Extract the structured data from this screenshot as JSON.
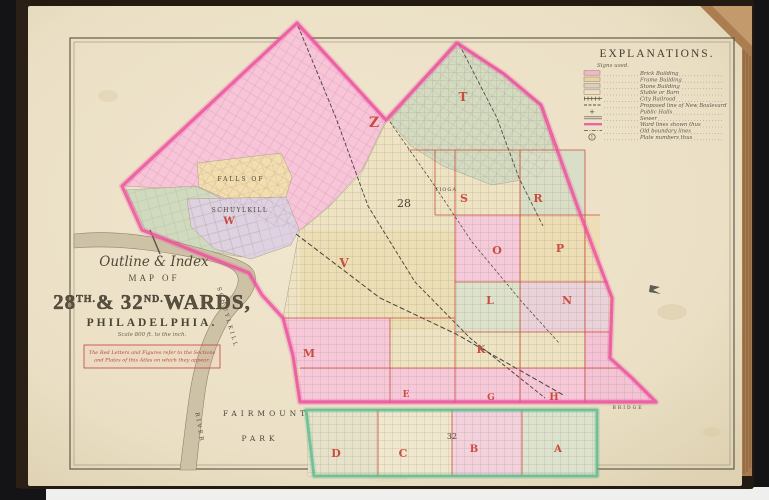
{
  "page_title": "Outline & Index Map of 28th & 32nd Wards, Philadelphia",
  "legend": {
    "title": "EXPLANATIONS.",
    "subtitle": "Signs used.",
    "items": [
      {
        "type": "swatch",
        "color": "#f0b6c9",
        "label": "Brick Building"
      },
      {
        "type": "swatch",
        "color": "#e9d3a2",
        "label": "Frame Building"
      },
      {
        "type": "swatch",
        "color": "#d8d1c0",
        "label": "Stone Building"
      },
      {
        "type": "swatch",
        "color": "none",
        "label": "Stable or Barn"
      },
      {
        "type": "railroad",
        "label": "City Railroad"
      },
      {
        "type": "dashed",
        "label": "Proposed line of New Boulevard"
      },
      {
        "type": "cross",
        "label": "Public Halls"
      },
      {
        "type": "double",
        "label": "Sewer"
      },
      {
        "type": "pink-line",
        "label": "Ward lines shown thus"
      },
      {
        "type": "dashdot",
        "label": "Old boundary lines"
      },
      {
        "type": "circle-number",
        "number": "1",
        "label": "Plate numbers thus"
      }
    ]
  },
  "title_block": {
    "line1": "Outline & Index",
    "line2": "MAP OF",
    "ward_main": "28",
    "ward_main_sup": "TH.",
    "ward_mid": "& 32",
    "ward_mid_sup": "ND.",
    "ward_tail": "WARDS,",
    "city": "PHILADELPHIA.",
    "scale_note": "Scale 800 ft. to the inch.",
    "note_line1": "The Red Letters and Figures refer to the Sections",
    "note_line2": "and Plates of this Atlas on which they appear."
  },
  "map": {
    "section_letters": [
      {
        "label": "Z",
        "x": 374,
        "y": 127,
        "size": 14
      },
      {
        "label": "T",
        "x": 463,
        "y": 101,
        "size": 12
      },
      {
        "label": "W",
        "x": 229,
        "y": 224,
        "size": 10
      },
      {
        "label": "S",
        "x": 464,
        "y": 202,
        "size": 11
      },
      {
        "label": "R",
        "x": 538,
        "y": 202,
        "size": 11
      },
      {
        "label": "O",
        "x": 497,
        "y": 254,
        "size": 11
      },
      {
        "label": "P",
        "x": 560,
        "y": 252,
        "size": 11
      },
      {
        "label": "L",
        "x": 490,
        "y": 304,
        "size": 11
      },
      {
        "label": "N",
        "x": 567,
        "y": 304,
        "size": 11
      },
      {
        "label": "V",
        "x": 344,
        "y": 267,
        "size": 12
      },
      {
        "label": "M",
        "x": 309,
        "y": 357,
        "size": 11
      },
      {
        "label": "K",
        "x": 481,
        "y": 353,
        "size": 10
      },
      {
        "label": "E",
        "x": 406,
        "y": 397,
        "size": 9
      },
      {
        "label": "G",
        "x": 491,
        "y": 400,
        "size": 9
      },
      {
        "label": "H",
        "x": 554,
        "y": 400,
        "size": 10
      },
      {
        "label": "D",
        "x": 336,
        "y": 457,
        "size": 11
      },
      {
        "label": "C",
        "x": 403,
        "y": 457,
        "size": 11
      },
      {
        "label": "B",
        "x": 474,
        "y": 452,
        "size": 10
      },
      {
        "label": "A",
        "x": 558,
        "y": 452,
        "size": 10
      }
    ],
    "place_labels": [
      {
        "text": "FALLS OF",
        "x": 241,
        "y": 181,
        "size": 6,
        "ls": 2,
        "rot": 0
      },
      {
        "text": "SCHUYLKILL",
        "x": 240,
        "y": 212,
        "size": 6,
        "ls": 1.5,
        "rot": 0
      },
      {
        "text": "TIOGA",
        "x": 446,
        "y": 191,
        "size": 5,
        "ls": 1,
        "rot": 0
      },
      {
        "text": "FAIRMOUNT",
        "x": 266,
        "y": 416,
        "size": 7.5,
        "ls": 4,
        "rot": 0
      },
      {
        "text": "PARK",
        "x": 260,
        "y": 441,
        "size": 7.5,
        "ls": 4,
        "rot": 0
      },
      {
        "text": "SCHUYLKILL",
        "x": 226,
        "y": 318,
        "size": 5.5,
        "ls": 2.5,
        "rot": 74
      },
      {
        "text": "RIVER",
        "x": 198,
        "y": 428,
        "size": 5.5,
        "ls": 2.5,
        "rot": 80
      },
      {
        "text": "BRIDGE",
        "x": 628,
        "y": 409,
        "size": 4.5,
        "ls": 2,
        "rot": 0,
        "color": "#8a8272"
      },
      {
        "text": "28",
        "x": 404,
        "y": 207,
        "size": 11,
        "ls": 0,
        "rot": 0,
        "color": "#3a352c"
      },
      {
        "text": "32",
        "x": 452,
        "y": 439,
        "size": 8,
        "ls": 0,
        "rot": 0,
        "color": "#3a352c"
      }
    ],
    "colors": {
      "ward28_boundary": "#ee4f9e",
      "ward32_boundary": "#56b98c",
      "section_line": "#c4402e",
      "section_letter": "#c43b2c",
      "paper": "#ede2c9",
      "river": "#cec2a6"
    }
  }
}
